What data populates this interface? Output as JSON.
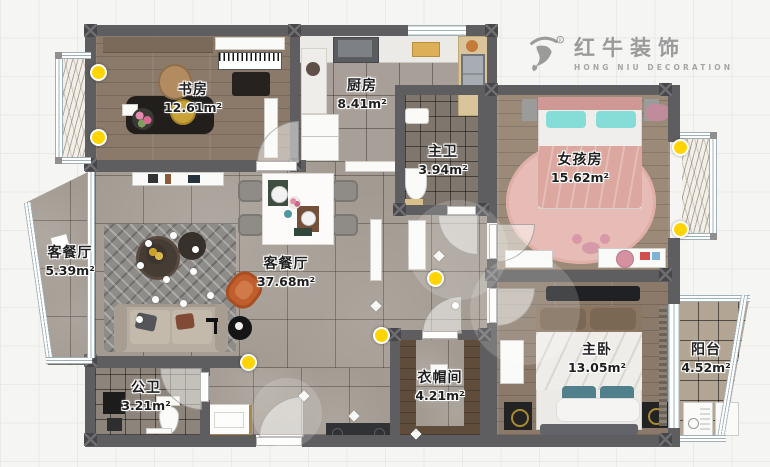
{
  "meta": {
    "type": "floor-plan",
    "width": 770,
    "height": 467
  },
  "logo": {
    "name": "红牛装饰",
    "subtitle": "HONG NIU DECORATION",
    "registered": "®",
    "icon": "bull-icon",
    "color": "#9b9b9b"
  },
  "rooms": [
    {
      "id": "study",
      "name": "书房",
      "area": "12.61m²"
    },
    {
      "id": "kitchen",
      "name": "厨房",
      "area": "8.41m²"
    },
    {
      "id": "master-bath",
      "name": "主卫",
      "area": "3.94m²"
    },
    {
      "id": "girls-room",
      "name": "女孩房",
      "area": "15.62m²"
    },
    {
      "id": "living-balcony",
      "name": "客餐厅",
      "area": "5.39m²"
    },
    {
      "id": "living-dining",
      "name": "客餐厅",
      "area": "37.68m²"
    },
    {
      "id": "public-bath",
      "name": "公卫",
      "area": "3.21m²"
    },
    {
      "id": "cloakroom",
      "name": "衣帽间",
      "area": "4.21m²"
    },
    {
      "id": "master-bedroom",
      "name": "主卧",
      "area": "13.05m²"
    },
    {
      "id": "balcony",
      "name": "阳台",
      "area": "4.52m²"
    }
  ],
  "colors": {
    "wall": "#5e5e60",
    "corner_block": "#47474a",
    "ceiling_light": "#ffd400",
    "wood_floor": "#8b7a6a",
    "tile_floor": "#a39b92",
    "logo_gray": "#9b9b9b"
  },
  "icons": {
    "lights": "ceiling-light-dot",
    "doors": "door-swing-arc",
    "windows": "double-line-window",
    "brand": "bull-icon"
  }
}
